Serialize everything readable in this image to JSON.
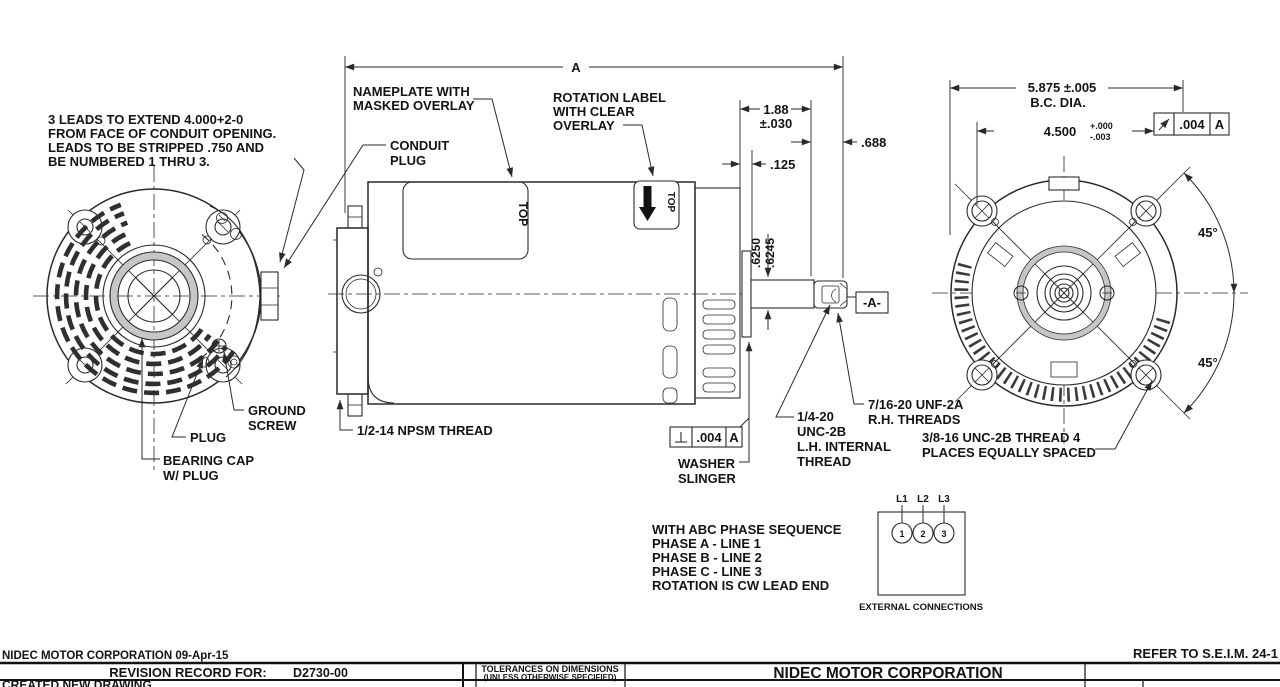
{
  "colors": {
    "line": "#2a2a2a",
    "text": "#141414",
    "background": "#ffffff"
  },
  "callouts": {
    "leads_note": [
      "3 LEADS TO EXTEND 4.000+2-0",
      "FROM FACE OF CONDUIT OPENING.",
      "LEADS TO BE STRIPPED .750 AND",
      "BE NUMBERED 1 THRU 3."
    ],
    "nameplate": [
      "NAMEPLATE WITH",
      "MASKED OVERLAY"
    ],
    "rotation_label": [
      "ROTATION LABEL",
      "WITH CLEAR",
      "OVERLAY"
    ],
    "conduit_plug": [
      "CONDUIT",
      "PLUG"
    ],
    "ground_screw": [
      "GROUND",
      "SCREW"
    ],
    "plug": "PLUG",
    "bearing_cap": [
      "BEARING CAP",
      "W/ PLUG"
    ],
    "npsm_thread": "1/2-14 NPSM THREAD",
    "washer_slinger": [
      "WASHER",
      "SLINGER"
    ],
    "internal_thread": [
      "1/4-20",
      "UNC-2B",
      "L.H. INTERNAL",
      "THREAD"
    ],
    "rh_threads": [
      "7/16-20 UNF-2A",
      "R.H. THREADS"
    ],
    "bolt_thread": [
      "3/8-16 UNC-2B THREAD 4",
      "PLACES EQUALLY SPACED"
    ],
    "top_nameplate": "TOP",
    "top_rotation": "TOP"
  },
  "dimensions": {
    "length_ref": "A",
    "dim_188": "1.88",
    "dim_188_tol": "±.030",
    "dim_688": ".688",
    "dim_125": ".125",
    "shaft_dia_upper": ".6250",
    "shaft_dia_lower": ".6245",
    "datum_a": "-A-",
    "bc_dia": "5.875 ±.005",
    "bc_dia_label": "B.C. DIA.",
    "pilot_dia": "4.500",
    "pilot_tol_plus": "+.000",
    "pilot_tol_minus": "-.003",
    "angle_upper": "45°",
    "angle_lower": "45°",
    "runout": {
      "symbol_icon": "perpendicularity",
      "value": ".004",
      "datum": "A"
    },
    "circular_runout": {
      "symbol_icon": "runout-arrow",
      "value": ".004",
      "datum": "A"
    }
  },
  "phase_notes": [
    "WITH ABC PHASE SEQUENCE",
    "PHASE A - LINE 1",
    "PHASE B - LINE 2",
    "PHASE C - LINE 3",
    "ROTATION IS CW LEAD END"
  ],
  "connections": {
    "terminals": [
      "L1",
      "L2",
      "L3"
    ],
    "numbers": [
      "1",
      "2",
      "3"
    ],
    "caption": "EXTERNAL CONNECTIONS"
  },
  "title_block": {
    "company_date": "NIDEC MOTOR CORPORATION 09-Apr-15",
    "refer_note": "REFER TO S.E.I.M. 24-1",
    "revision_record_label": "REVISION RECORD FOR:",
    "drawing_number": "D2730-00",
    "tolerances_line1": "TOLERANCES ON DIMENSIONS",
    "tolerances_line2": "(UNLESS OTHERWISE SPECIFIED)",
    "company": "NIDEC MOTOR CORPORATION",
    "revision_note": "CREATED NEW DRAWING."
  }
}
